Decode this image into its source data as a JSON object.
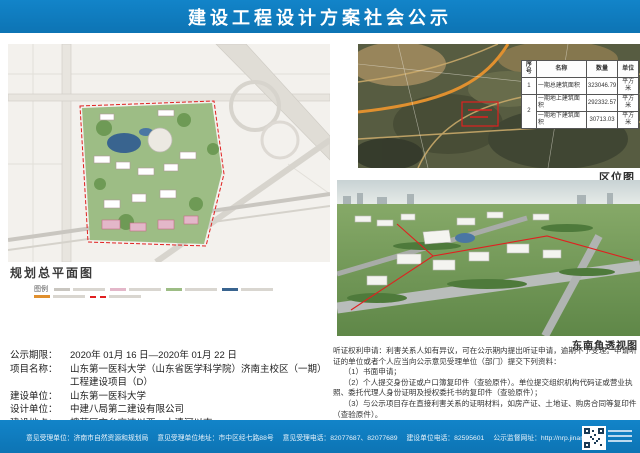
{
  "header": {
    "title": "建设工程设计方案社会公示"
  },
  "site_plan": {
    "label": "规划总平面图",
    "legend_title": "图例"
  },
  "location_map": {
    "label": "区位图"
  },
  "perspective": {
    "label": "东南角透视图"
  },
  "area_table": {
    "headers": [
      "序号",
      "名称",
      "数量",
      "单位"
    ],
    "rows": [
      {
        "no": "1",
        "name": "一期总建筑面积",
        "qty": "323046.79",
        "unit": "平方米"
      },
      {
        "no": "2",
        "name": "一期地上建筑面积",
        "qty": "292332.57",
        "unit": "平方米"
      },
      {
        "no": "",
        "name": "一期地下建筑面积",
        "qty": "30713.03",
        "unit": "平方米"
      }
    ]
  },
  "project_info": {
    "lines": [
      {
        "label": "公示期限：",
        "value": "2020年 01月 16 日—2020年 01月 22 日"
      },
      {
        "label": "项目名称：",
        "value": "山东第一医科大学（山东省医学科学院）济南主校区（一期）工程建设项目（D）"
      },
      {
        "label": "建设单位：",
        "value": "山东第一医科大学"
      },
      {
        "label": "设计单位：",
        "value": "中建八局第二建设有限公司"
      },
      {
        "label": "建设地点：",
        "value": "槐荫区京台高速以西，小清河以南"
      }
    ]
  },
  "hearing_notice": {
    "paragraphs": [
      "听证权利申请：利害关系人如有异议，可在公示期内提出听证申请，逾期不予受理。申请听证的单位或者个人应当向公示意见受理单位（部门）提交下列资料：",
      "（1）书面申请；",
      "（2）个人提交身份证或户口簿复印件（查验原件）。单位提交组织机构代码证或营业执照、委托代理人身份证明及授权委托书的复印件（查验原件）；",
      "（3）与公示项目存在直接利害关系的证明材料，如房产证、土地证、购房合同等复印件（查验原件）。",
      "济南市自然资源和规划局将对听证申请及相关材料进行审查后，做出是否听证的决定并书面告知听证申请人。"
    ]
  },
  "footer": {
    "items": [
      "意见受理单位：济南市自然资源和规划局",
      "意见受理单位地址：市中区经七路88号",
      "意见受理电话：82077687、82077689",
      "建设单位电话：82595601",
      "公示监督网址：http://nrp.jinan.gov.cn"
    ]
  },
  "colors": {
    "banner_blue": "#0f7cc0",
    "plan_green": "#9dbd85",
    "pond_blue": "#39648f",
    "highlight_red": "#e02020",
    "road_orange": "#e0902f"
  }
}
